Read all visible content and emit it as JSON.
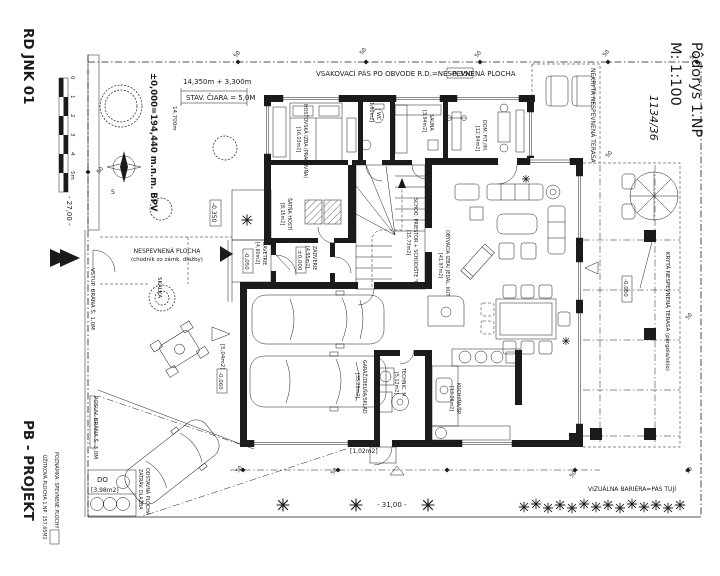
{
  "colors": {
    "ink": "#1b1b1b",
    "paper": "#ffffff"
  },
  "title_block": {
    "project_code": "RD JNK 01",
    "author": "PB - PROJEKT",
    "drawing_name": "Pôdorys 1.NP",
    "scale": "M: 1:100",
    "parcel": "1134/36",
    "datum": "±0,000=194,440 m.n.m. BPV"
  },
  "dimensions": {
    "top_chain": "14,350m + 3,300m",
    "building_line": "STAV. ČIARA = 5,0M",
    "side_offset": "14,700m",
    "plot_width": "- 31,00 -",
    "plot_depth": "- 27,00 -",
    "setback": "50"
  },
  "levels": {
    "terrain_top": "-0,350",
    "terrain_left": "-0,350",
    "entry": "±0,000",
    "porch": "-0,050",
    "terrace": "-0,050",
    "driveway": "-0,060"
  },
  "site": {
    "infiltration_note": "VSAKOVACÍ PÁS PO OBVODE R.D.=NESPEVNENÁ PLOCHA",
    "uncovered_terrace": "NEKRYTÁ NESPEVNENÁ TERASA",
    "covered_terrace": "KRYTÁ NESPEVNENÁ TERASA (pergola/sklo)",
    "walkway_line1": "NESPEVNENÁ PLOCHA",
    "walkway_line2": "(chodník zo zámk. dlažby)",
    "rock_garden": "SKALKA",
    "entry_gate": "VSTUP. BRÁNA Š. 1,0M",
    "sliding_gate": "POSUV. BRÁNA Š. 3,0M",
    "parking_line1": "ODSTAVNÁ PLOCHA",
    "parking_line2": "ZATRÁV. DLAŽBA",
    "bins_label": "DO",
    "bins_area": "[3,98m2]",
    "hedge_note": "VIZUÁLNA BARIÉRA=PÁS TUJÍ",
    "drive_pad_area": "[5,04m2]",
    "back_pad_area": "[1,02m2]",
    "usable_area": "ÚŽITKOVÁ PLOCHA 1.NP: 157,65M2",
    "note_paved": "POZNÁMKA: SPEVNENÉ PLOCHY",
    "south_mark": "S"
  },
  "rooms": {
    "guest": {
      "name": "HOSŤOVSKÁ IZBA (PRACOVŇA)",
      "area": "[16,03m2]"
    },
    "wc": {
      "name": "WC",
      "area": "[1,50m2]"
    },
    "sauna": {
      "name": "SAUNA",
      "area": "[3,94m2]"
    },
    "fitness": {
      "name": "DOM. FIT./IM.",
      "area": "[12,84m2]"
    },
    "wardrobe": {
      "name": "ŠATŇA HOSTÍ",
      "area": "[8,15m2]"
    },
    "vestibule": {
      "name": "ZÁDVERIE",
      "area": "[4,95m2]"
    },
    "porch": {
      "name": "ZÁVETRIE",
      "area": "[4,60m2]"
    },
    "staircase": {
      "name": "SCHOD. PRIESTOR + SCHODIŠTE \"L\"",
      "area": "[15,73m2]"
    },
    "living": {
      "name": "OBÝVACIA IZBA/ JEDÁL. KÚT",
      "area": "[41,97m2]"
    },
    "garage": {
      "name": "GARÁŽ/DIELŇA/SKLAD",
      "area": "[35,28m2]"
    },
    "technical": {
      "name": "TECHNIC. M.",
      "area": "[5,12m2]"
    },
    "kitchen": {
      "name": "KUCHYŇA/ŠP.",
      "area": "[13,28m2]"
    }
  },
  "scalebar": {
    "t0": "0",
    "t1": "1",
    "t2": "2",
    "t3": "3",
    "t4": "4",
    "t5": "5m"
  }
}
